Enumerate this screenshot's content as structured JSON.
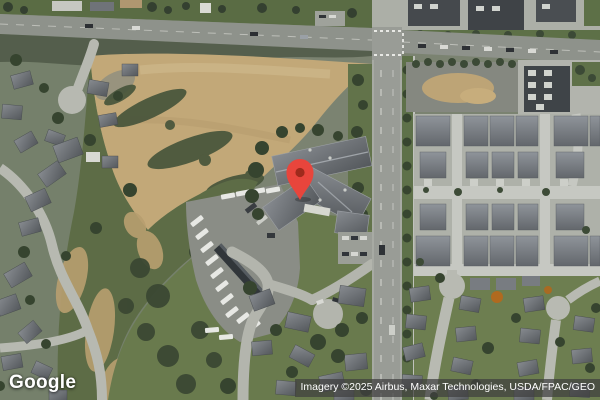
{
  "map": {
    "view_type_label": "Satellite",
    "marker": {
      "color": "#E8453C",
      "dot_color": "#9E2A1C",
      "shadow_color": "rgba(0,0,0,0.25)",
      "position": {
        "x": 300,
        "y": 199
      }
    },
    "palette": {
      "dry_field_tan": "#C2A878",
      "scrub_green": "#5D6C46",
      "lawn_green": "#697A4D",
      "road_gray": "#999C96",
      "pavement_light": "#AEB1A9",
      "roof_dark": "#54585C",
      "tree_dark": "#36442F",
      "vehicle_white": "#E7E8E4"
    }
  },
  "branding": {
    "logo_text": "Google"
  },
  "attribution": {
    "text": "Imagery ©2025 Airbus, Maxar Technologies, USDA/FPAC/GEO"
  }
}
